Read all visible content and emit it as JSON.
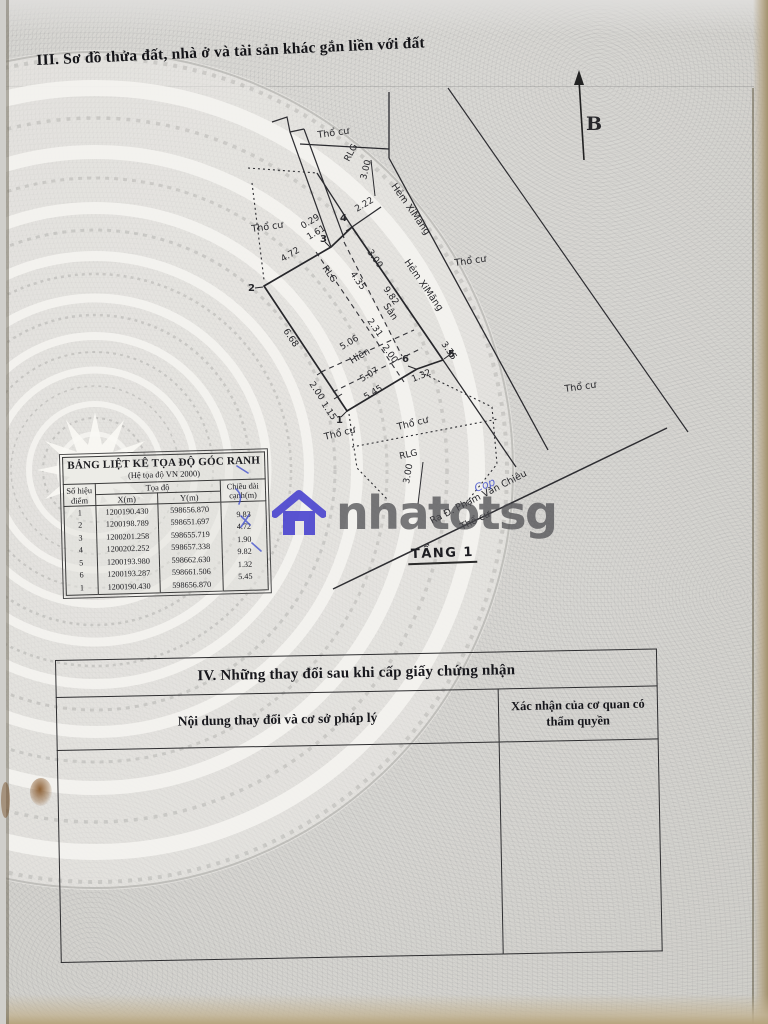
{
  "page": {
    "section3_title": "III. Sơ đồ thửa đất, nhà ở và tài sản khác gắn liền với đất",
    "north_label": "B",
    "floor_label": "TẦNG 1",
    "watermark_text": "nhatotsg"
  },
  "colors": {
    "pen_blue": "#3a49cc",
    "logo_indigo": "#4a44cf",
    "ink": "#2b2b2b"
  },
  "diagram": {
    "labels": {
      "tho_cu": "Thổ cư",
      "rlg": "RLG",
      "hem_ximang": "Hẻm XiMăng",
      "san": "Sân",
      "hien": "Hiên",
      "street": "Ra Đ. Phạm Văn Chiêu",
      "handwriting": "Cop"
    },
    "points": {
      "p1": "1",
      "p2": "2",
      "p3": "3",
      "p4": "4",
      "p5": "5",
      "p6": "6"
    },
    "dims": {
      "a472": "4.72",
      "a029": "0.29",
      "a161": "1.61",
      "a222": "2.22",
      "a300": "3.00",
      "a435": "4.35",
      "a982": "9.82",
      "a231": "2.31",
      "a200": "2.00",
      "a506": "5.06",
      "a507": "5.07",
      "a668": "6.68",
      "a115": "1.15",
      "a545": "5.45",
      "a132": "1.32",
      "a335": "3.35"
    }
  },
  "coord_table": {
    "title": "BẢNG LIỆT KÊ TỌA ĐỘ GÓC RANH",
    "subtitle": "(Hệ tọa độ VN 2000)",
    "col_point": "Số hiệu điểm",
    "col_coords": "Tọa độ",
    "col_x": "X(m)",
    "col_y": "Y(m)",
    "col_len": "Chiều dài cạnh(m)",
    "rows": [
      [
        "1",
        "1200190.430",
        "598656.870",
        "9.83"
      ],
      [
        "2",
        "1200198.789",
        "598651.697",
        "4.72"
      ],
      [
        "3",
        "1200201.258",
        "598655.719",
        "1.90"
      ],
      [
        "4",
        "1200202.252",
        "598657.338",
        "9.82"
      ],
      [
        "5",
        "1200193.980",
        "598662.630",
        "1.32"
      ],
      [
        "6",
        "1200193.287",
        "598661.506",
        "5.45"
      ],
      [
        "1",
        "1200190.430",
        "598656.870",
        ""
      ]
    ]
  },
  "section4": {
    "title": "IV. Những thay đổi sau khi cấp giấy chứng nhận",
    "col_left": "Nội dung thay đổi và cơ sở pháp lý",
    "col_right": "Xác nhận của cơ quan có thẩm quyền"
  }
}
